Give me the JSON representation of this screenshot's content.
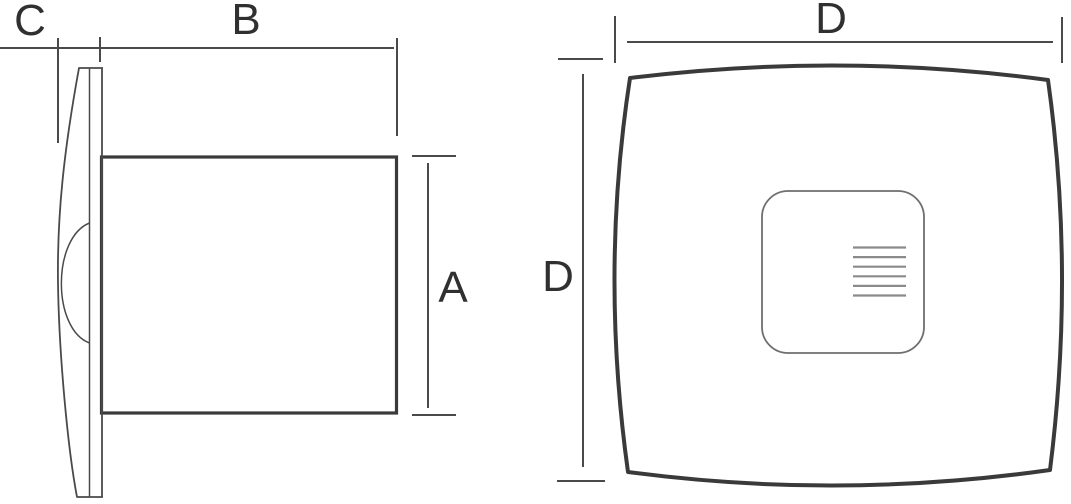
{
  "labels": {
    "side_cover_depth": "C",
    "side_body_length": "B",
    "side_body_height": "A",
    "front_width": "D",
    "front_height": "D"
  },
  "front_view": {
    "grille_slat_count": 6
  },
  "colors": {
    "line": "#3a3a3a",
    "dim": "#4a4a4a",
    "panel": "#6f6f6f",
    "slat": "#8a8a8a",
    "label": "#303030",
    "background": "#ffffff"
  }
}
